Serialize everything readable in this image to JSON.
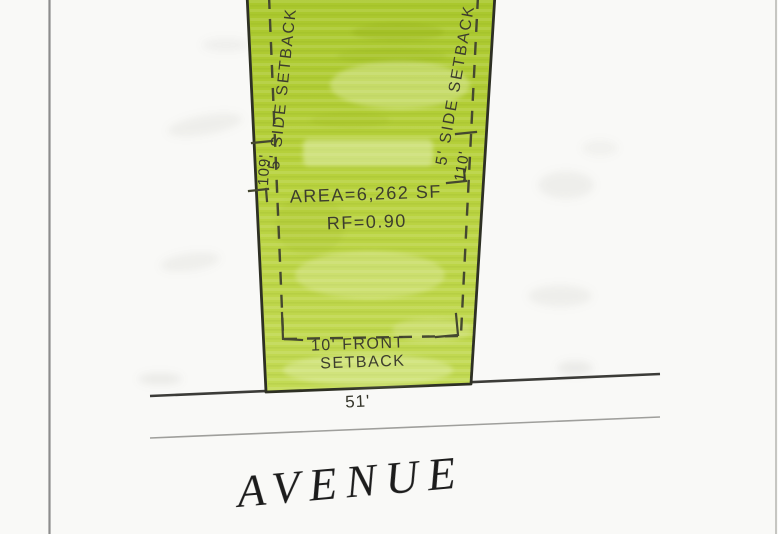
{
  "plat": {
    "area_label": "AREA=6,262 SF",
    "rf_label": "RF=0.90",
    "front_setback_line1": "10' FRONT",
    "front_setback_line2": "SETBACK",
    "frontage_dimension": "51'",
    "left_depth_dimension": "109'",
    "right_depth_dimension": "110'",
    "left_side_setback_label": "5' SIDE SETBACK",
    "right_side_setback_label": "5' SIDE SETBACK",
    "street_name": "AVENUE"
  },
  "colors": {
    "highlight_green": "#b7d13c",
    "highlight_green_light": "#c3da55",
    "highlight_green_dark": "#a9c72c",
    "lot_outline": "#2e3024",
    "setback_dash": "#454830",
    "label_text": "#3c3e2d",
    "dimension_text": "#34352a",
    "street_line": "#3c3c38",
    "street_line_faint": "#90908c",
    "street_text": "#1f1f1f",
    "page_border": "#8d8d8d",
    "page_border_faint": "#b9b9b5",
    "paper": "#f9f9f7"
  }
}
